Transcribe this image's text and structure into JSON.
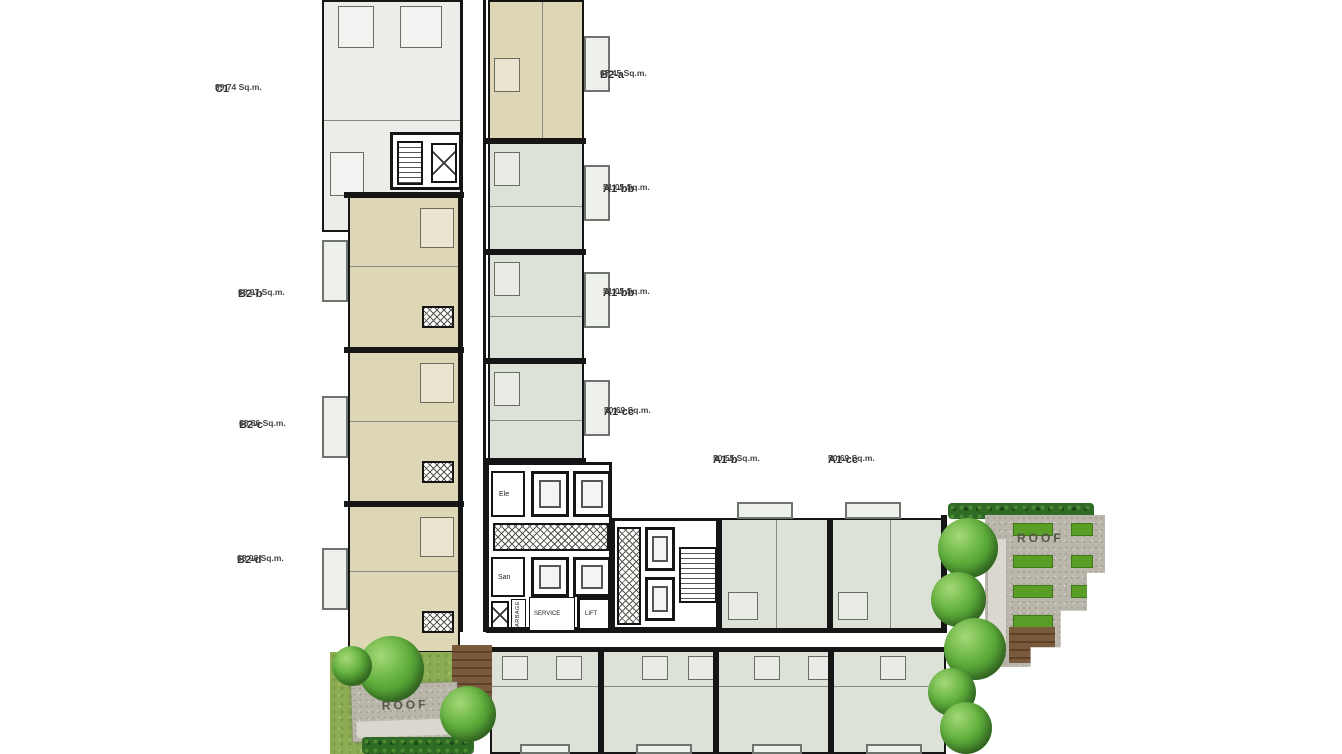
{
  "title": "Residential floor plan",
  "units": [
    {
      "name": "C1",
      "area": "99.74 Sq.m."
    },
    {
      "name": "B2-a",
      "area": "67.45 Sq.m."
    },
    {
      "name": "A1-bb",
      "area": "51.05 Sq.m."
    },
    {
      "name": "A1-bb",
      "area": "51.05 Sq.m."
    },
    {
      "name": "A1-cc",
      "area": "50.69 Sq.m."
    },
    {
      "name": "B2-b",
      "area": "68.97 Sq.m."
    },
    {
      "name": "B2-c",
      "area": "68.86 Sq.m."
    },
    {
      "name": "B2-d",
      "area": "68.98 Sq.m."
    },
    {
      "name": "A1-b",
      "area": "50.55 Sq.m."
    },
    {
      "name": "A1-cc",
      "area": "50.69 Sq.m."
    }
  ],
  "core": {
    "ele": "Ele",
    "san": "San",
    "service": "SERVICE",
    "service_lift": "LIFT",
    "garbage": "GARBAGE"
  },
  "roof": {
    "right": "ROOF",
    "bottom_left": "ROOF"
  },
  "colors": {
    "wall": "#151515",
    "unit_beige": "#ded7b6",
    "unit_sage": "#dde2d9",
    "unit_gray": "#ecece9",
    "lawn": "#8cab52",
    "tree": "#4f9a33",
    "gravel": "#bab6ac",
    "wood": "#7a5a3c",
    "planter": "#5a9e27",
    "hedge": "#2f6b24"
  }
}
